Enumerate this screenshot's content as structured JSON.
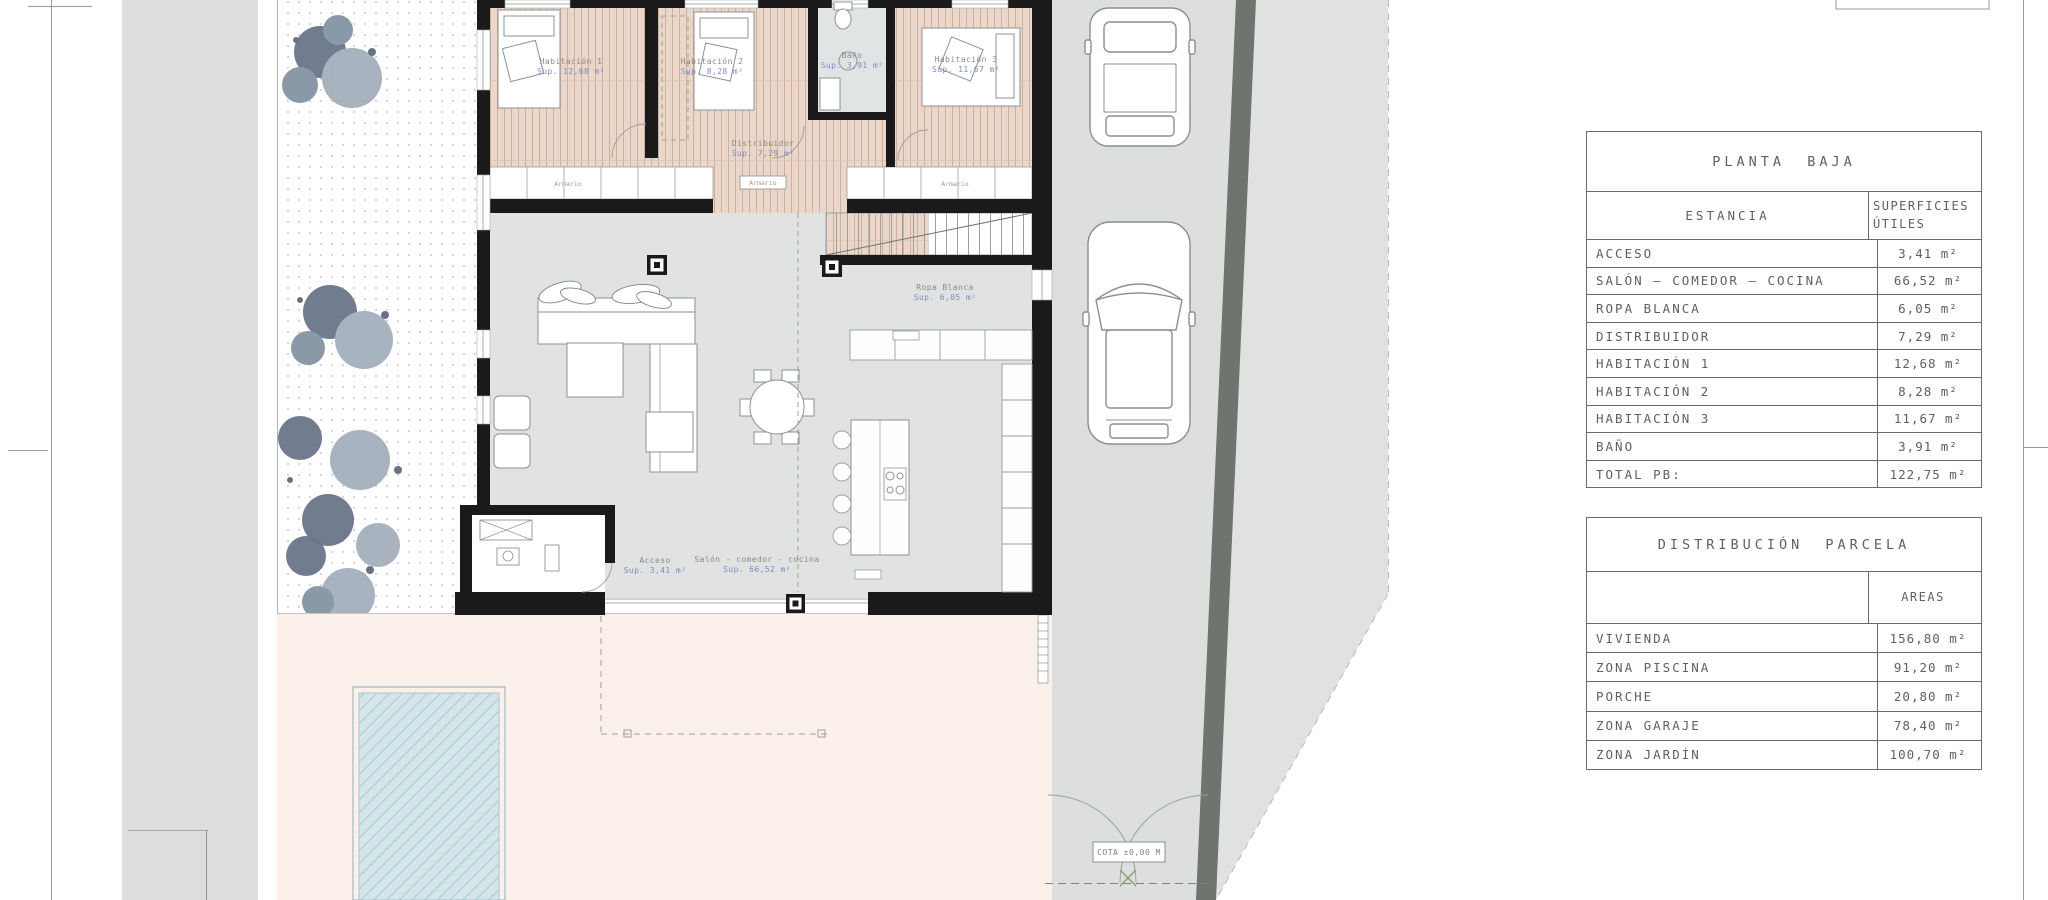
{
  "tables": {
    "planta_baja": {
      "title": "PLANTA BAJA",
      "col_estancia": "ESTANCIA",
      "col_superficies": "SUPERFICIES ÚTILES",
      "rows": [
        {
          "label": "ACCESO",
          "value": "3,41 m²"
        },
        {
          "label": "SALÓN — COMEDOR — COCINA",
          "value": "66,52 m²"
        },
        {
          "label": "ROPA BLANCA",
          "value": "6,05 m²"
        },
        {
          "label": "DISTRIBUIDOR",
          "value": "7,29 m²"
        },
        {
          "label": "HABITACIÓN 1",
          "value": "12,68 m²"
        },
        {
          "label": "HABITACIÓN 2",
          "value": "8,28 m²"
        },
        {
          "label": "HABITACIÓN 3",
          "value": "11,67 m²"
        },
        {
          "label": "BAÑO",
          "value": "3,91 m²"
        },
        {
          "label": "TOTAL PB:",
          "value": "122,75 m²"
        }
      ]
    },
    "distribucion_parcela": {
      "title": "DISTRIBUCIÓN PARCELA",
      "col_areas": "AREAS",
      "rows": [
        {
          "label": "VIVIENDA",
          "value": "156,80 m²"
        },
        {
          "label": "ZONA PISCINA",
          "value": "91,20 m²"
        },
        {
          "label": "PORCHE",
          "value": "20,80 m²"
        },
        {
          "label": "ZONA GARAJE",
          "value": "78,40 m²"
        },
        {
          "label": "ZONA JARDÍN",
          "value": "100,70 m²"
        }
      ]
    }
  },
  "plan": {
    "rooms": {
      "habitacion1": {
        "name": "Habitación 1",
        "sup": "Sup. 12,68 m²"
      },
      "habitacion2": {
        "name": "Habitación 2",
        "sup": "Sup. 8,28 m²"
      },
      "habitacion3": {
        "name": "Habitación 3",
        "sup": "Sup. 11,67 m²"
      },
      "bano": {
        "name": "Baño",
        "sup": "Sup. 3,91 m²"
      },
      "distribuidor": {
        "name": "Distribuidor",
        "sup": "Sup. 7,29 m²"
      },
      "ropa_blanca": {
        "name": "Ropa Blanca",
        "sup": "Sup. 6,05 m²"
      },
      "acceso": {
        "name": "Acceso",
        "sup": "Sup. 3,41 m²"
      },
      "salon": {
        "name": "Salón - comedor - cocina",
        "sup": "Sup. 66,52 m²"
      }
    },
    "armario_label": "Armario",
    "cota_label": "COTA ±0,00 M"
  },
  "colors": {
    "wall": "#1a1a1a",
    "wood_floor": "#ead7c9",
    "gray_floor": "#e0e3e2",
    "driveway": "#dcdfde",
    "terrace": "#fcf0ea",
    "pool": "#d5e6ea",
    "boundary_band": "#6f746f",
    "tree_dark": "#6a7789",
    "tree_light": "#a3afbb",
    "label_blue": "#7b8cc4"
  }
}
